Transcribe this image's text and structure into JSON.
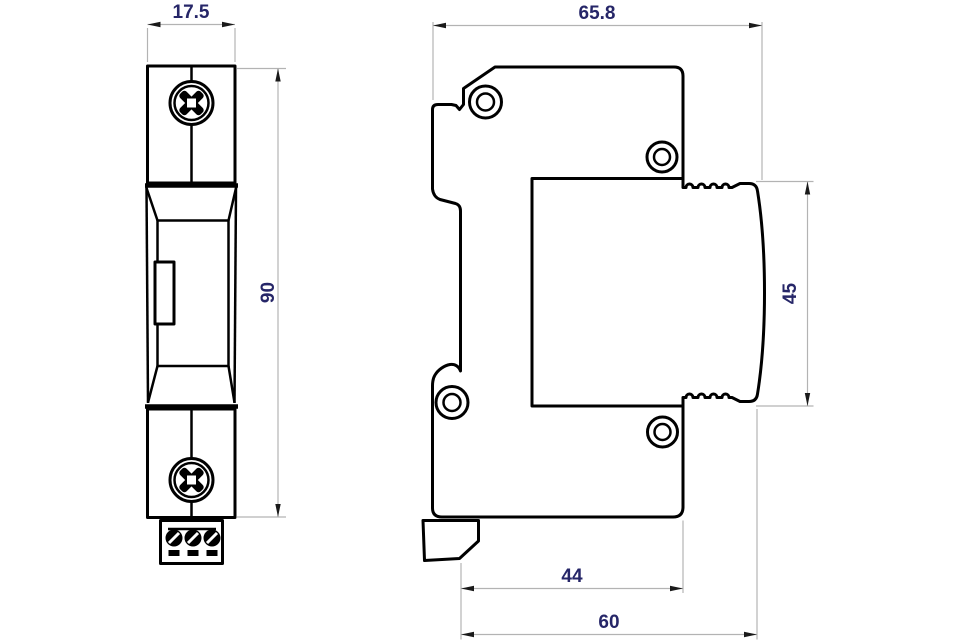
{
  "front_view": {
    "width_label": "17.5",
    "height_label": "90"
  },
  "side_view": {
    "width_label": "65.8",
    "module_height_label": "45",
    "mount_depth_label": "44",
    "total_depth_label": "60"
  },
  "colors": {
    "outline": "#000000",
    "dimension_line": "#b3b3b3",
    "dimension_text": "#262668",
    "background": "#ffffff"
  }
}
